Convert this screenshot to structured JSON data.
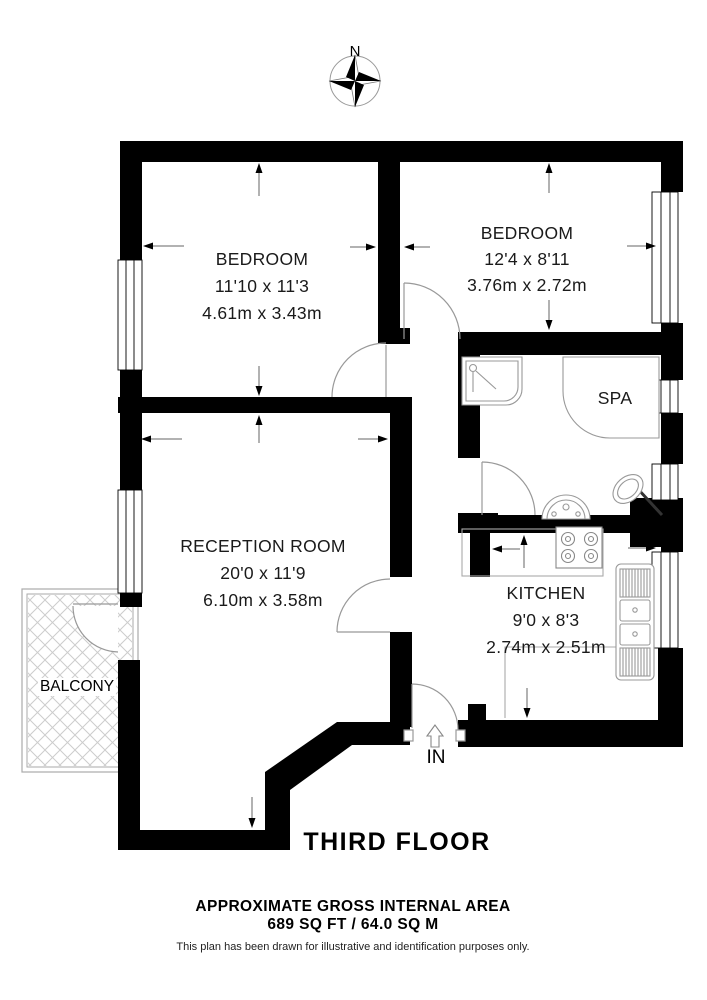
{
  "compass": {
    "north_label": "N"
  },
  "rooms": {
    "bedroom1": {
      "name": "BEDROOM",
      "imperial": "11'10 x 11'3",
      "metric": "4.61m x 3.43m"
    },
    "bedroom2": {
      "name": "BEDROOM",
      "imperial": "12'4 x 8'11",
      "metric": "3.76m x 2.72m"
    },
    "reception": {
      "name": "RECEPTION ROOM",
      "imperial": "20'0 x 11'9",
      "metric": "6.10m x 3.58m"
    },
    "kitchen": {
      "name": "KITCHEN",
      "imperial": "9'0 x 8'3",
      "metric": "2.74m x 2.51m"
    },
    "spa": {
      "name": "SPA"
    },
    "balcony": {
      "name": "BALCONY"
    }
  },
  "entrance": {
    "label": "IN"
  },
  "footer": {
    "floor_title": "THIRD FLOOR",
    "area_heading": "APPROXIMATE GROSS INTERNAL AREA",
    "area_value": "689 SQ FT / 64.0 SQ M",
    "disclaimer": "This plan has been drawn for illustrative and identification purposes only."
  },
  "colors": {
    "wall": "#000000",
    "fixture_line": "#999999",
    "hatch_line": "#cccccc"
  }
}
